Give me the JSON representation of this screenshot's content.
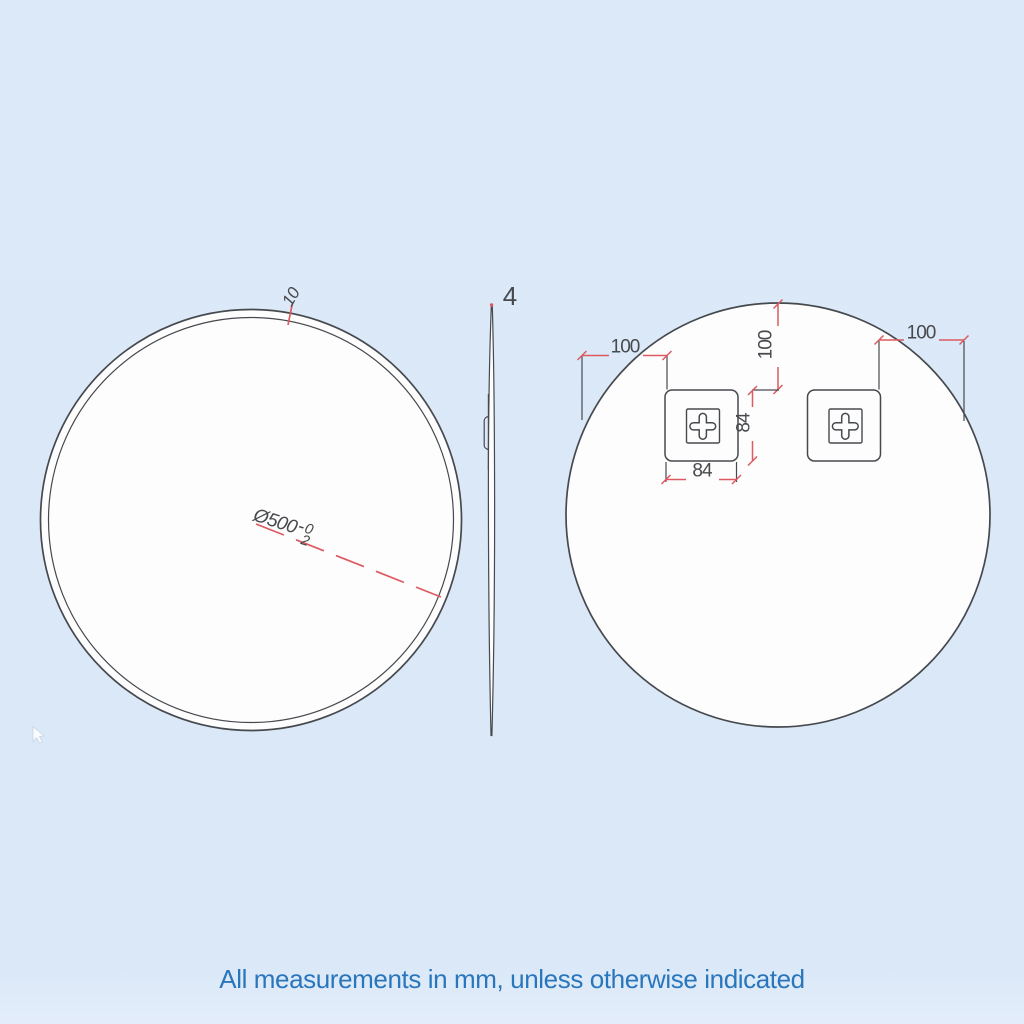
{
  "front_view": {
    "frame_thickness": "10",
    "diameter": "Ø500",
    "tolerance_dash": "-",
    "tolerance_upper": "0",
    "tolerance_lower": "2"
  },
  "side_view": {
    "thickness": "4"
  },
  "back_view": {
    "left_offset": "100",
    "top_offset": "100",
    "right_offset": "100",
    "bracket_height": "84",
    "bracket_width": "84"
  },
  "footer": {
    "note": "All measurements in mm, unless otherwise indicated"
  },
  "colors": {
    "background": "#dbe9f8",
    "line_gray": "#46494d",
    "dimension_red": "#dc5a60",
    "note_blue": "#2a76bc",
    "shape_fill": "#fdfdfe"
  }
}
